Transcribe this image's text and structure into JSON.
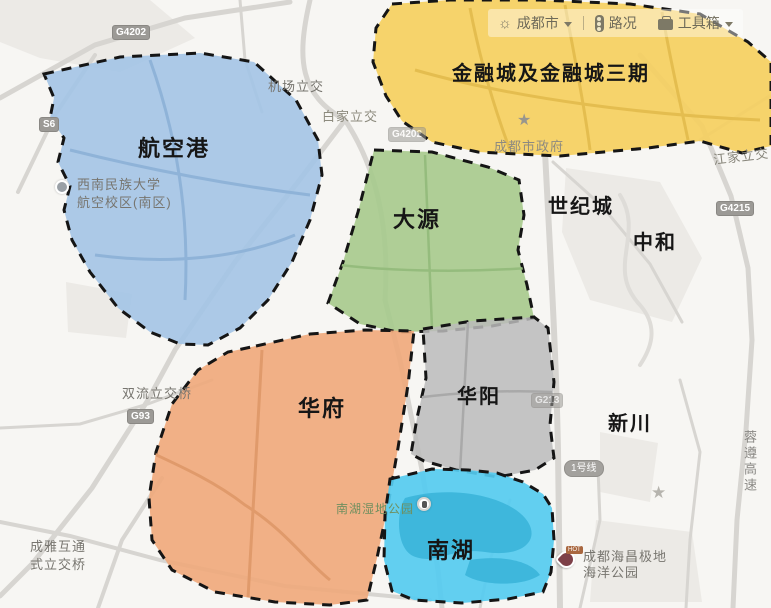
{
  "toolbar": {
    "city": "成都市",
    "traffic": "路况",
    "toolbox": "工具箱"
  },
  "regions": {
    "hangkonggang": {
      "label": "航空港",
      "color": "#a3c4e6"
    },
    "jinrongcheng": {
      "label": "金融城及金融城三期",
      "color": "#f5cf5f"
    },
    "dayuan": {
      "label": "大源",
      "color": "#a6ca8c"
    },
    "huafu": {
      "label": "华府",
      "color": "#f0a87a"
    },
    "huayang": {
      "label": "华阳",
      "color": "#bbbbbb"
    },
    "nanhu": {
      "label": "南湖",
      "color": "#55cbf0"
    }
  },
  "districts": {
    "shijicheng": "世纪城",
    "zhonghe": "中和",
    "xinchuan": "新川"
  },
  "pois": {
    "airport_interchange": "机场立交",
    "baijia_interchange": "白家立交",
    "city_government": "成都市政府",
    "jiangjia_interchange": "江家立交",
    "university_line1": "西南民族大学",
    "university_line2": "航空校区(南区)",
    "shuangliu_interchange": "双流立交桥",
    "nanhu_wetland_park": "南湖湿地公园",
    "ocean_park_line1": "成都海昌极地",
    "ocean_park_line2": "海洋公园",
    "chengya_line1": "成雅互通",
    "chengya_line2": "式立交桥",
    "rongzun_expressway": "蓉遵高速"
  },
  "badges": {
    "g4202_nw": "G4202",
    "s6": "S6",
    "g4202_mid": "G4202",
    "g93": "G93",
    "g4215": "G4215",
    "g213": "G213",
    "metro1": "1号线"
  },
  "icons": {
    "sun": "☼",
    "star": "★",
    "hot": "HOT"
  }
}
